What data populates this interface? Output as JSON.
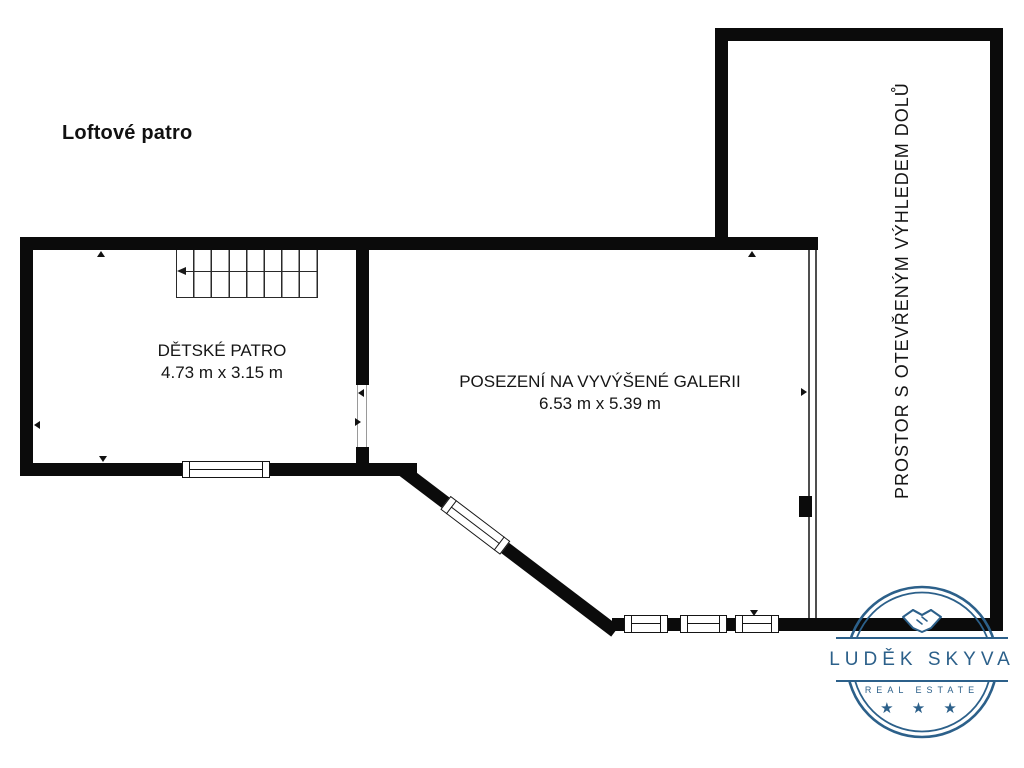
{
  "title": "Loftové patro",
  "rooms": [
    {
      "name": "DĚTSKÉ PATRO",
      "dimensions": "4.73 m x 3.15 m"
    },
    {
      "name": "POSEZENÍ NA VYVÝŠENÉ GALERII",
      "dimensions": "6.53 m x 5.39 m"
    },
    {
      "name": "PROSTOR S OTEVŘENÝM VÝHLEDEM DOLŮ"
    }
  ],
  "stairs": {
    "treads": 8,
    "direction": "left"
  },
  "logo": {
    "name": "LUDĚK SKYVA",
    "subtitle": "REAL ESTATE",
    "stars": "★ ★ ★",
    "icon": "handshake-icon",
    "color": "#2c608a"
  },
  "colors": {
    "wall": "#0b0b0b",
    "background": "#ffffff",
    "accent": "#2c608a"
  }
}
